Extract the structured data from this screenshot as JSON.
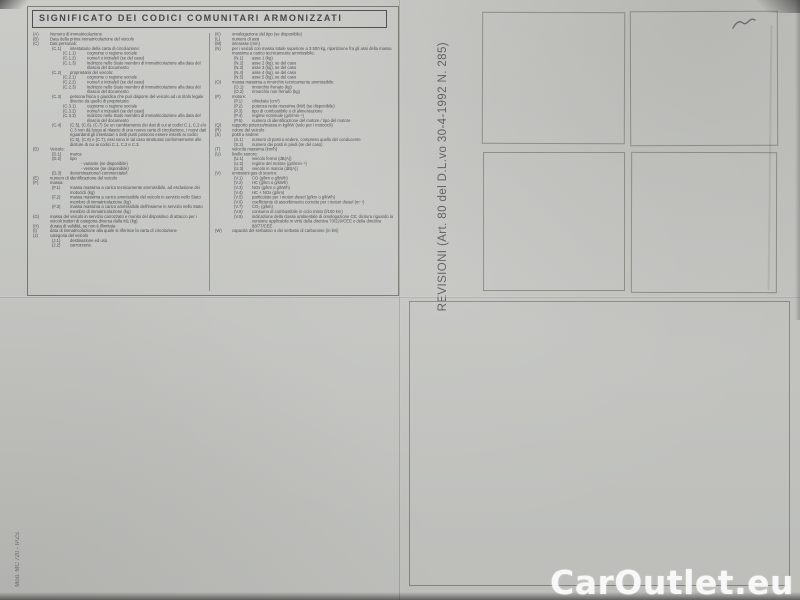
{
  "document": {
    "title": "SIGNIFICATO DEI CODICI COMUNITARI ARMONIZZATI",
    "legend": {
      "left": [
        {
          "c": "(A)",
          "t": "Numero di immatricolazione",
          "l": 0
        },
        {
          "c": "(B)",
          "t": "Data della prima immatricolazione del veicolo",
          "l": 0
        },
        {
          "c": "(C)",
          "t": "Dati personali:",
          "l": 0
        },
        {
          "c": "(C.1)",
          "t": "intestatario della carta di circolazione:",
          "l": 1
        },
        {
          "c": "(C.1.1)",
          "t": "cognome o ragione sociale",
          "l": 2
        },
        {
          "c": "(C.1.2)",
          "t": "nome/i o iniziale/i (se del caso)",
          "l": 2
        },
        {
          "c": "(C.1.3)",
          "t": "indirizzo nello Stato membro di immatricolazione alla data del rilascio del documento",
          "l": 2
        },
        {
          "c": "(C.2)",
          "t": "proprietario del veicolo:",
          "l": 1
        },
        {
          "c": "(C.2.1)",
          "t": "cognome o ragione sociale",
          "l": 2
        },
        {
          "c": "(C.2.2)",
          "t": "nome/i o iniziale/i (se del caso)",
          "l": 2
        },
        {
          "c": "(C.2.3)",
          "t": "indirizzo nello Stato membro di immatricolazione alla data del rilascio del documento",
          "l": 2
        },
        {
          "c": "(C.3)",
          "t": "persona fisica o giuridica che può disporre del veicolo ad un titolo legale diverso da quello di proprietario:",
          "l": 1
        },
        {
          "c": "(C.3.1)",
          "t": "cognome o ragione sociale",
          "l": 2
        },
        {
          "c": "(C.3.2)",
          "t": "nome/i o iniziale/i (se del caso)",
          "l": 2
        },
        {
          "c": "(C.3.3)",
          "t": "indirizzo nello Stato membro di immatricolazione alla data del rilascio del documento",
          "l": 2
        },
        {
          "c": "(C.4)",
          "t": "(C.5), (C.6), (C.7) Se un cambiamento dei dati di cui ai codici C.1, C.2 e/o C.3 non dà luogo al rilascio di una nuova carta di circolazione, i nuovi dati riguardanti gli intestatari o detti punti possono essere inseriti ai codici (C.5), (C.6) e (C.7); essi sono in tal caso strutturati conformemente alle diciture di cui ai codici C.1, C.2 e C.3.",
          "l": 1
        },
        {
          "c": "(D)",
          "t": "Veicolo:",
          "l": 0
        },
        {
          "c": "(D.1)",
          "t": "marca",
          "l": 1
        },
        {
          "c": "(D.2)",
          "t": "tipo",
          "l": 1
        },
        {
          "c": "",
          "t": "- variante (se disponibile)",
          "l": 3
        },
        {
          "c": "",
          "t": "- versione (se disponibile)",
          "l": 3
        },
        {
          "c": "(D.3)",
          "t": "denominazione/i commerciale/i",
          "l": 1
        },
        {
          "c": "(E)",
          "t": "numero di identificazione del veicolo",
          "l": 0
        },
        {
          "c": "(F)",
          "t": "massa:",
          "l": 0
        },
        {
          "c": "(F.1)",
          "t": "massa massima a carico tecnicamente ammissibile, ad esclusione dei motocicli (kg)",
          "l": 1
        },
        {
          "c": "(F.2)",
          "t": "massa massima a carico ammissibile del veicolo in servizio nello Stato membro di immatricolazione (kg)",
          "l": 1
        },
        {
          "c": "(F.3)",
          "t": "massa massima a carico ammissibile dell'insieme in servizio nello Stato membro di immatricolazione (kg)",
          "l": 1
        },
        {
          "c": "(G)",
          "t": "massa del veicolo in servizio carrozzato e munito del dispositivo di attacco per i veicoli trattori di categoria diversa dalla M1 (kg)",
          "l": 0
        },
        {
          "c": "(H)",
          "t": "durata di validità, se non è illimitata",
          "l": 0
        },
        {
          "c": "(I)",
          "t": "data di immatricolazione alla quale si riferisce la carta di circolazione",
          "l": 0
        },
        {
          "c": "(J)",
          "t": "categoria del veicolo",
          "l": 0
        },
        {
          "c": "(J.1)",
          "t": "destinazione ed uso",
          "l": 1
        },
        {
          "c": "(J.2)",
          "t": "carrozzeria",
          "l": 1
        }
      ],
      "right": [
        {
          "c": "(K)",
          "t": "omologazione del tipo (se disponibile)",
          "l": 0
        },
        {
          "c": "(L)",
          "t": "numero di assi",
          "l": 0
        },
        {
          "c": "(M)",
          "t": "interasse (mm)",
          "l": 0
        },
        {
          "c": "(N)",
          "t": "per i veicoli con massa totale superiore a 3.500 kg, ripartizione fra gli assi della massa massima a carico tecnicamente ammissibile:",
          "l": 0
        },
        {
          "c": "(N.1)",
          "t": "asse 1 (kg)",
          "l": 1
        },
        {
          "c": "(N.2)",
          "t": "asse 2 (kg), se del caso",
          "l": 1
        },
        {
          "c": "(N.3)",
          "t": "asse 3 (kg), se del caso",
          "l": 1
        },
        {
          "c": "(N.4)",
          "t": "asse 4 (kg), se del caso",
          "l": 1
        },
        {
          "c": "(N.5)",
          "t": "asse 5 (kg), se del caso",
          "l": 1
        },
        {
          "c": "(O)",
          "t": "massa massima a rimorchio tecnicamente ammissibile:",
          "l": 0
        },
        {
          "c": "(O.1)",
          "t": "rimorchio frenato (kg)",
          "l": 1
        },
        {
          "c": "(O.2)",
          "t": "rimorchio non frenato (kg)",
          "l": 1
        },
        {
          "c": "(P)",
          "t": "motore:",
          "l": 0
        },
        {
          "c": "(P.1)",
          "t": "cilindrata (cm³)",
          "l": 1
        },
        {
          "c": "(P.2)",
          "t": "potenza netta massima (kW) (se disponibile)",
          "l": 1
        },
        {
          "c": "(P.3)",
          "t": "tipo di combustibile o di alimentazione",
          "l": 1
        },
        {
          "c": "(P.4)",
          "t": "regime nominale (giri/min⁻¹)",
          "l": 1
        },
        {
          "c": "(P.5)",
          "t": "numero di identificazione del motore / tipo del motore",
          "l": 1
        },
        {
          "c": "(Q)",
          "t": "rapporto potenza/massa in kg/kW (solo per i motocicli)",
          "l": 0
        },
        {
          "c": "(R)",
          "t": "colore del veicolo",
          "l": 0
        },
        {
          "c": "(S)",
          "t": "posti a sedere:",
          "l": 0
        },
        {
          "c": "(S.1)",
          "t": "numero di posti a sedere, compreso quello del conducente",
          "l": 1
        },
        {
          "c": "(S.2)",
          "t": "numero dei posti in piedi (se del caso)",
          "l": 1
        },
        {
          "c": "(T)",
          "t": "velocità massima (km/h)",
          "l": 0
        },
        {
          "c": "(U)",
          "t": "livello sonoro:",
          "l": 0
        },
        {
          "c": "(U.1)",
          "t": "veicolo fermo (dB(A))",
          "l": 1
        },
        {
          "c": "(U.2)",
          "t": "regime del motore (giri/min⁻¹)",
          "l": 1
        },
        {
          "c": "(U.3)",
          "t": "veicolo in marcia (dB(A))",
          "l": 1
        },
        {
          "c": "(V)",
          "t": "emissioni gas di scarico:",
          "l": 0
        },
        {
          "c": "(V.1)",
          "t": "CO (g/km o g/kWh)",
          "l": 1
        },
        {
          "c": "(V.2)",
          "t": "HC (g/km o g/kWh)",
          "l": 1
        },
        {
          "c": "(V.3)",
          "t": "NOx (g/km o g/kWh)",
          "l": 1
        },
        {
          "c": "(V.4)",
          "t": "HC + NOx (g/km)",
          "l": 1
        },
        {
          "c": "(V.5)",
          "t": "particolato per i motori diesel (g/km o g/kWh)",
          "l": 1
        },
        {
          "c": "(V.6)",
          "t": "coefficiente di assorbimento corretto per i motori diesel (m⁻¹)",
          "l": 1
        },
        {
          "c": "(V.7)",
          "t": "CO₂ (g/km)",
          "l": 1
        },
        {
          "c": "(V.8)",
          "t": "consumo di combustibile in ciclo misto (l/100 km)",
          "l": 1
        },
        {
          "c": "(V.9)",
          "t": "indicazione della classe ambientale di omologazione CE; dicitura riguardo la versione applicabile in virtù della direttiva 70/220/CEE o della direttiva 88/77/CEE",
          "l": 1
        },
        {
          "c": "(W)",
          "t": "capacità del serbatoio o dei serbatoi di carburante (in litri)",
          "l": 0
        }
      ]
    },
    "revisions_sidebar": {
      "label": "REVISIONI (Art. 80 del D.L.vo 30-4-1992 N. 285)",
      "stamp_box_count": 4,
      "large_box_count": 1
    },
    "handwritten_mark": "pen-squiggle",
    "print_code": "Mod. MC 720 - IPZS",
    "watermark": "CarOutlet.eu",
    "colors": {
      "paper": "#c7c8c4",
      "ink": "#45464b",
      "box_border": "#8b8b83",
      "watermark": "#fcfcfc"
    }
  }
}
